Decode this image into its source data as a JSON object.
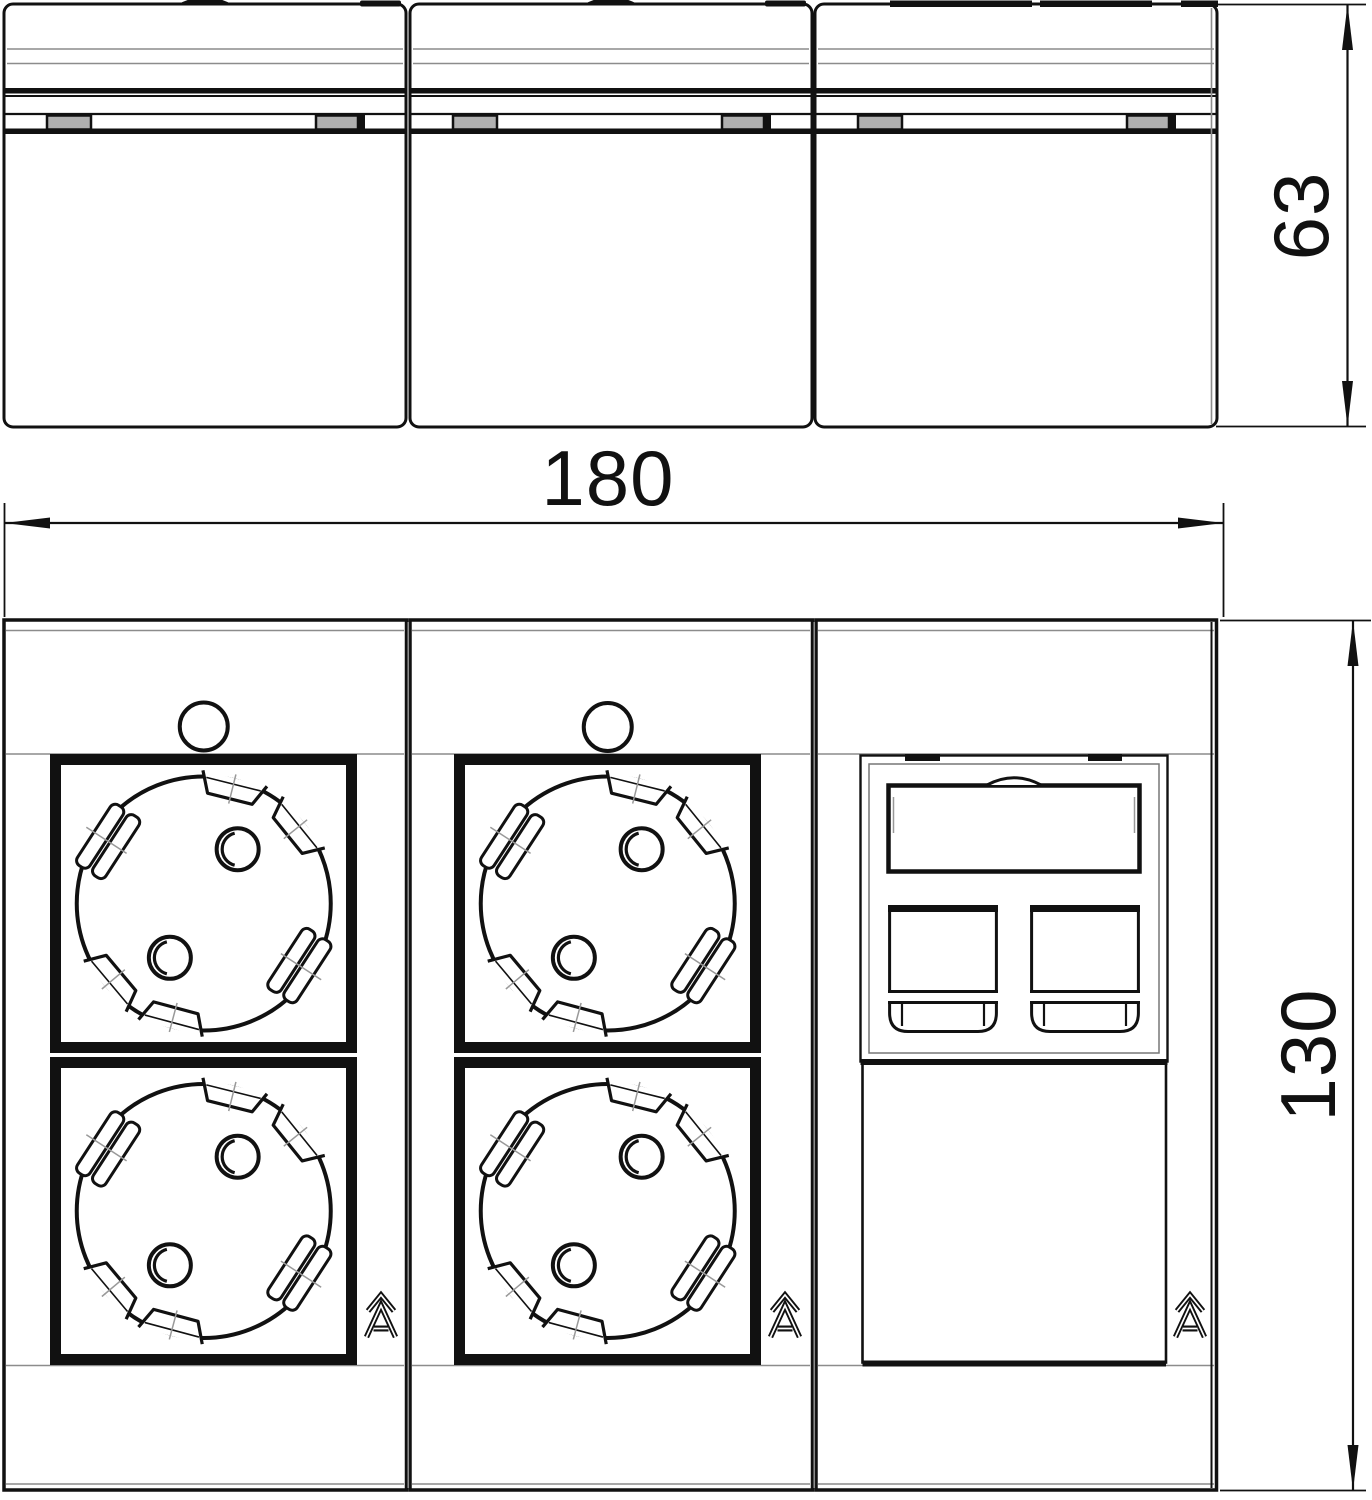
{
  "drawing": {
    "type": "product-dimension-drawing",
    "views": [
      "top-profile-view",
      "front-view"
    ]
  },
  "dimension_labels": {
    "width": "180",
    "depth": "63",
    "height": "130"
  },
  "icons": {
    "logo": "chevron-A-manufacturer-logo",
    "socket": "schuko-socket-outlet",
    "data_jack": "rj45-jack-opening"
  },
  "colors": {
    "line": "#111111",
    "thin_gray": "#8c8c8c",
    "tab_fill": "#b0b0b0",
    "background": "#ffffff"
  }
}
